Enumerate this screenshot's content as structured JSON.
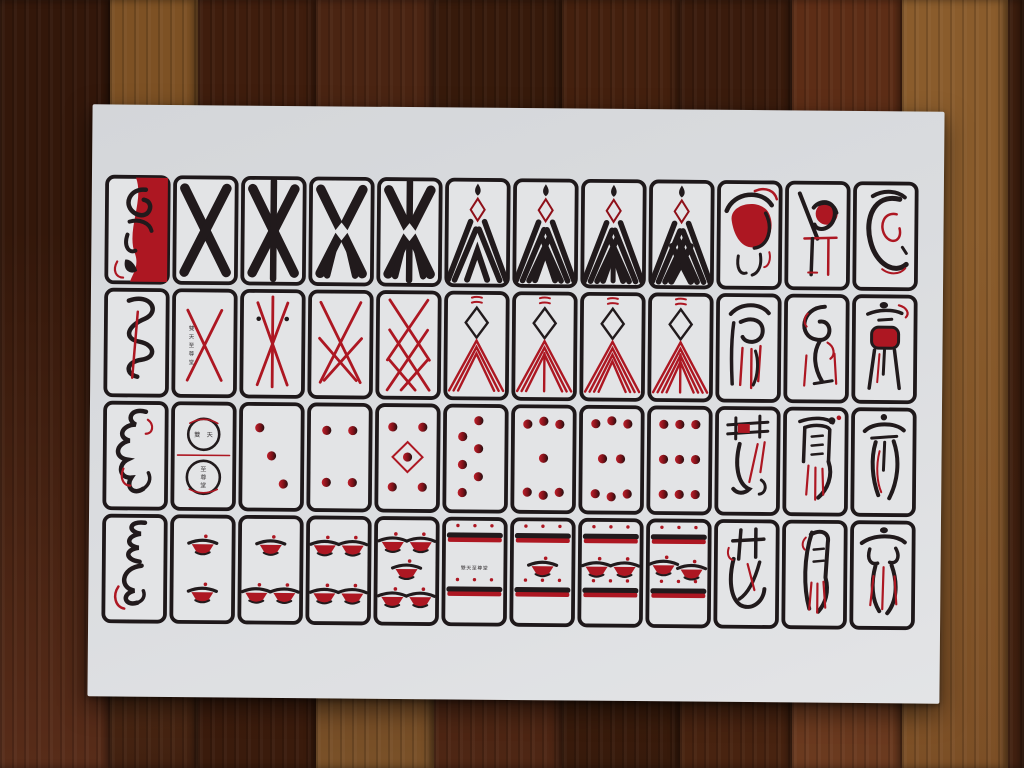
{
  "scene": {
    "description": "photograph of a printed sheet of 48 oriental playing cards lying on a dark wooden plank floor",
    "paper_color": "#d9dbde",
    "wood_planks": [
      {
        "x": 0,
        "w": 110,
        "top": "#33170a",
        "bottom": "#582c19"
      },
      {
        "x": 110,
        "w": 88,
        "top": "#7d5124",
        "bottom": "#412010"
      },
      {
        "x": 198,
        "w": 118,
        "top": "#3f1d0d",
        "bottom": "#3a1b0c"
      },
      {
        "x": 316,
        "w": 118,
        "top": "#4a2412",
        "bottom": "#7a5128"
      },
      {
        "x": 434,
        "w": 128,
        "top": "#371a0b",
        "bottom": "#4e2614"
      },
      {
        "x": 562,
        "w": 118,
        "top": "#44200e",
        "bottom": "#371a0b"
      },
      {
        "x": 680,
        "w": 112,
        "top": "#3a1b0c",
        "bottom": "#482310"
      },
      {
        "x": 792,
        "w": 110,
        "top": "#5d2d16",
        "bottom": "#6b3a1f"
      },
      {
        "x": 902,
        "w": 106,
        "top": "#8a5c2c",
        "bottom": "#7c4f26"
      },
      {
        "x": 1008,
        "w": 16,
        "top": "#3c1d0d",
        "bottom": "#432110"
      }
    ]
  },
  "palette": {
    "ink_black": "#211a1c",
    "ink_red": "#ad1722",
    "ink_dark_red": "#8f1019",
    "card_bg": "#e3e4e6",
    "border": "#1e181a",
    "text_ink": "#3a3638"
  },
  "maker_mark": {
    "text": "雙天至尊堂"
  },
  "grid": {
    "rows": 4,
    "cols": 12
  },
  "cards": [
    {
      "row": 1,
      "col": 1,
      "kind": "figure",
      "fig": "r1c1",
      "name": "ace-figure-red-robe"
    },
    {
      "row": 1,
      "col": 2,
      "kind": "x",
      "vertical": false,
      "diamond": false,
      "legs": false,
      "name": "double-cross-2"
    },
    {
      "row": 1,
      "col": 3,
      "kind": "x",
      "vertical": true,
      "diamond": false,
      "legs": false,
      "name": "cross-with-staff-3"
    },
    {
      "row": 1,
      "col": 4,
      "kind": "x",
      "vertical": false,
      "diamond": true,
      "legs": true,
      "name": "crossed-tent-4"
    },
    {
      "row": 1,
      "col": 5,
      "kind": "x",
      "vertical": true,
      "diamond": true,
      "legs": true,
      "name": "crossed-tent-staff-5"
    },
    {
      "row": 1,
      "col": 6,
      "kind": "chevB",
      "n": 2,
      "stem": false,
      "name": "black-peaks-6"
    },
    {
      "row": 1,
      "col": 7,
      "kind": "chevB",
      "n": 3,
      "stem": false,
      "name": "black-peaks-7"
    },
    {
      "row": 1,
      "col": 8,
      "kind": "chevB",
      "n": 3,
      "stem": true,
      "name": "black-peaks-8"
    },
    {
      "row": 1,
      "col": 9,
      "kind": "chevB",
      "n": 4,
      "stem": false,
      "name": "black-peaks-9"
    },
    {
      "row": 1,
      "col": 10,
      "kind": "figure",
      "fig": "r1c10",
      "name": "red-cloak-figure"
    },
    {
      "row": 1,
      "col": 11,
      "kind": "figure",
      "fig": "r1c11",
      "name": "perched-crane-figure"
    },
    {
      "row": 1,
      "col": 12,
      "kind": "figure",
      "fig": "r1c12",
      "name": "coiled-glyph-figure"
    },
    {
      "row": 2,
      "col": 1,
      "kind": "figure",
      "fig": "r2c1",
      "name": "ink-spiral-shell"
    },
    {
      "row": 2,
      "col": 2,
      "kind": "lattice",
      "v": 1,
      "name": "red-cross-2-maker-mark"
    },
    {
      "row": 2,
      "col": 3,
      "kind": "lattice",
      "v": 2,
      "name": "red-cross-staff-3"
    },
    {
      "row": 2,
      "col": 4,
      "kind": "lattice",
      "v": 3,
      "name": "red-lattice-4"
    },
    {
      "row": 2,
      "col": 5,
      "kind": "lattice",
      "v": 4,
      "name": "red-lattice-5"
    },
    {
      "row": 2,
      "col": 6,
      "kind": "chevR",
      "n": 3,
      "stem": false,
      "name": "red-peaks-6"
    },
    {
      "row": 2,
      "col": 7,
      "kind": "chevR",
      "n": 3,
      "stem": true,
      "name": "red-peaks-7"
    },
    {
      "row": 2,
      "col": 8,
      "kind": "chevR",
      "n": 4,
      "stem": false,
      "name": "red-peaks-8"
    },
    {
      "row": 2,
      "col": 9,
      "kind": "chevR",
      "n": 4,
      "stem": true,
      "name": "red-peaks-9"
    },
    {
      "row": 2,
      "col": 10,
      "kind": "figure",
      "fig": "r2c10",
      "name": "tasseled-robe-figure"
    },
    {
      "row": 2,
      "col": 11,
      "kind": "figure",
      "fig": "r2c11",
      "name": "stork-figure"
    },
    {
      "row": 2,
      "col": 12,
      "kind": "figure",
      "fig": "r2c12",
      "name": "red-altar-table"
    },
    {
      "row": 3,
      "col": 1,
      "kind": "figure",
      "fig": "r3c1",
      "name": "ink-beast"
    },
    {
      "row": 3,
      "col": 2,
      "kind": "circle2",
      "name": "double-rings-maker-card"
    },
    {
      "row": 3,
      "col": 3,
      "kind": "dots",
      "n": 3,
      "name": "three-coins"
    },
    {
      "row": 3,
      "col": 4,
      "kind": "dots",
      "n": 4,
      "name": "four-coins"
    },
    {
      "row": 3,
      "col": 5,
      "kind": "dots",
      "n": 5,
      "name": "five-coins"
    },
    {
      "row": 3,
      "col": 6,
      "kind": "dots",
      "n": 6,
      "name": "six-coins"
    },
    {
      "row": 3,
      "col": 7,
      "kind": "dots",
      "n": 7,
      "name": "seven-coins"
    },
    {
      "row": 3,
      "col": 8,
      "kind": "dots",
      "n": 8,
      "name": "eight-coins"
    },
    {
      "row": 3,
      "col": 9,
      "kind": "dots",
      "n": 9,
      "name": "nine-coins"
    },
    {
      "row": 3,
      "col": 10,
      "kind": "figure",
      "fig": "r3c10",
      "name": "noble-glyph"
    },
    {
      "row": 3,
      "col": 11,
      "kind": "figure",
      "fig": "r3c11",
      "name": "steed-glyph"
    },
    {
      "row": 3,
      "col": 12,
      "kind": "figure",
      "fig": "r3c12",
      "name": "emperor-glyph"
    },
    {
      "row": 4,
      "col": 1,
      "kind": "figure",
      "fig": "r4c1",
      "name": "triple-ribbon-glyph"
    },
    {
      "row": 4,
      "col": 2,
      "kind": "bowls",
      "n": 2,
      "name": "two-boats"
    },
    {
      "row": 4,
      "col": 3,
      "kind": "bowls",
      "n": 3,
      "name": "three-boats"
    },
    {
      "row": 4,
      "col": 4,
      "kind": "bowls",
      "n": 4,
      "name": "four-boats"
    },
    {
      "row": 4,
      "col": 5,
      "kind": "bowls",
      "n": 5,
      "name": "five-boats"
    },
    {
      "row": 4,
      "col": 6,
      "kind": "bars",
      "mid": "text",
      "name": "double-raft-maker-card"
    },
    {
      "row": 4,
      "col": 7,
      "kind": "bars",
      "mid": "b1",
      "name": "double-raft-one-boat"
    },
    {
      "row": 4,
      "col": 8,
      "kind": "bars",
      "mid": "b2",
      "name": "double-raft-two-boats"
    },
    {
      "row": 4,
      "col": 9,
      "kind": "bars",
      "mid": "b2t",
      "name": "double-raft-two-boats-tilted"
    },
    {
      "row": 4,
      "col": 10,
      "kind": "figure",
      "fig": "r4c10",
      "name": "gate-glyph"
    },
    {
      "row": 4,
      "col": 11,
      "kind": "figure",
      "fig": "r4c11",
      "name": "moon-glyph"
    },
    {
      "row": 4,
      "col": 12,
      "kind": "figure",
      "fig": "r4c12",
      "name": "robed-emperor-glyph"
    }
  ]
}
